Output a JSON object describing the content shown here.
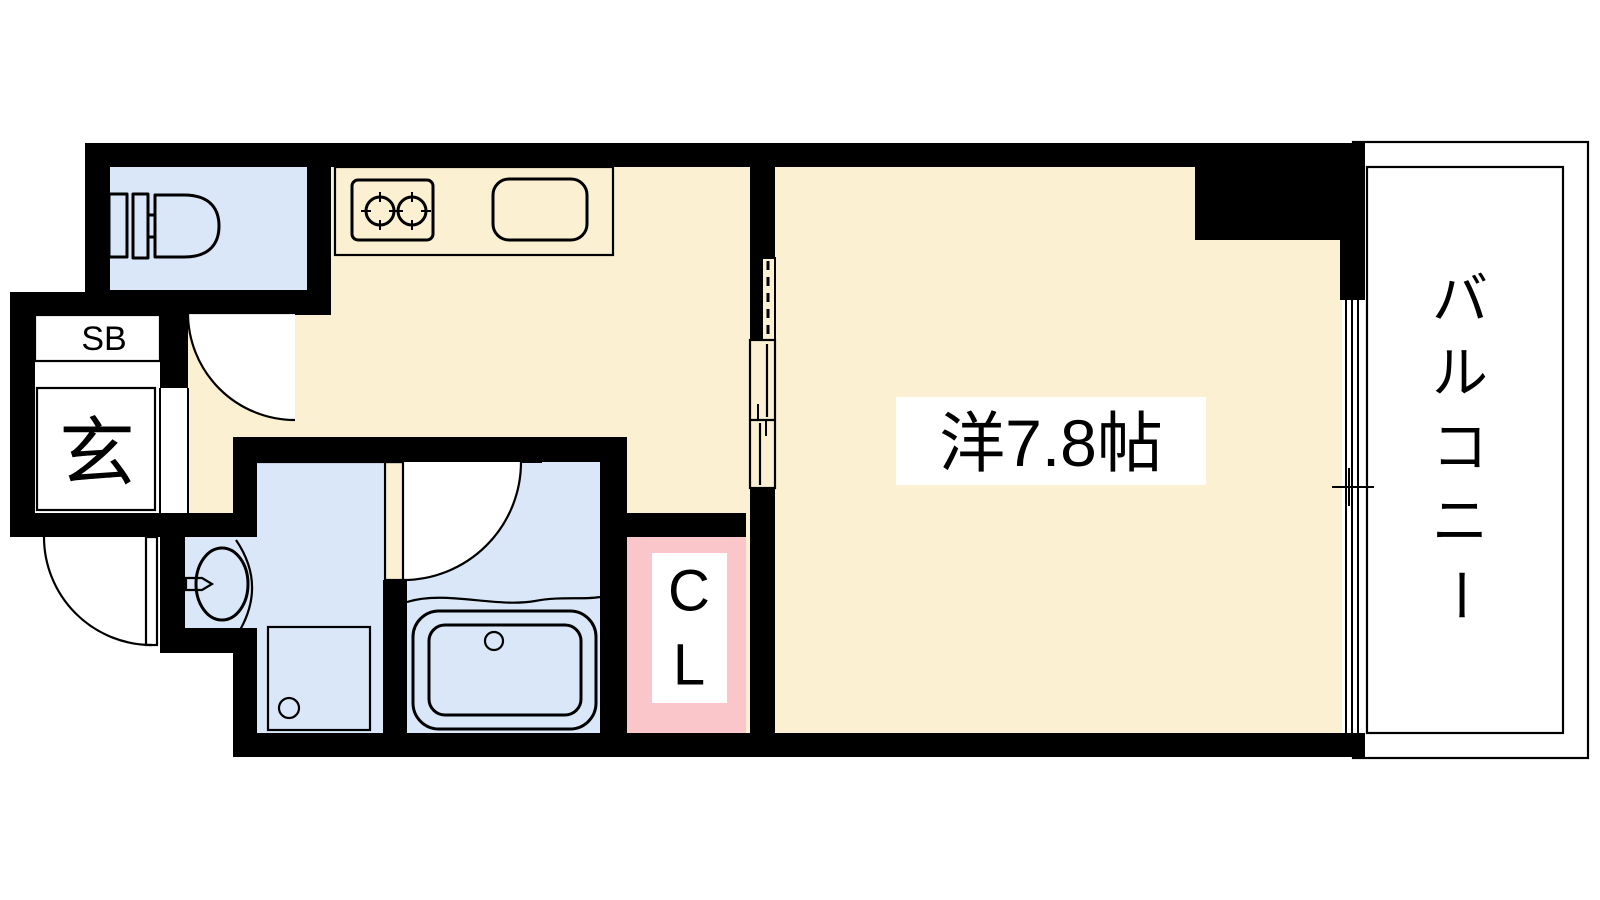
{
  "floorplan": {
    "type": "Japanese apartment 1K floor plan",
    "colors": {
      "wall": "#000000",
      "floor": "#FBF0D1",
      "wet_area": "#D9E7F8",
      "kitchen_counter": "#E8DEF3",
      "closet_pink": "#FBC6C9",
      "gray": "#D2D2D2",
      "label_bg": "#FFFFFF"
    },
    "labels": {
      "western_room": "洋7.8帖",
      "balcony": "バルコニー",
      "balcony_chars": [
        "バ",
        "ル",
        "コ",
        "ニ",
        "ー"
      ],
      "closet": "CL",
      "closet_chars": [
        "C",
        "L"
      ],
      "shoe_box": "SB",
      "entrance": "玄"
    }
  }
}
